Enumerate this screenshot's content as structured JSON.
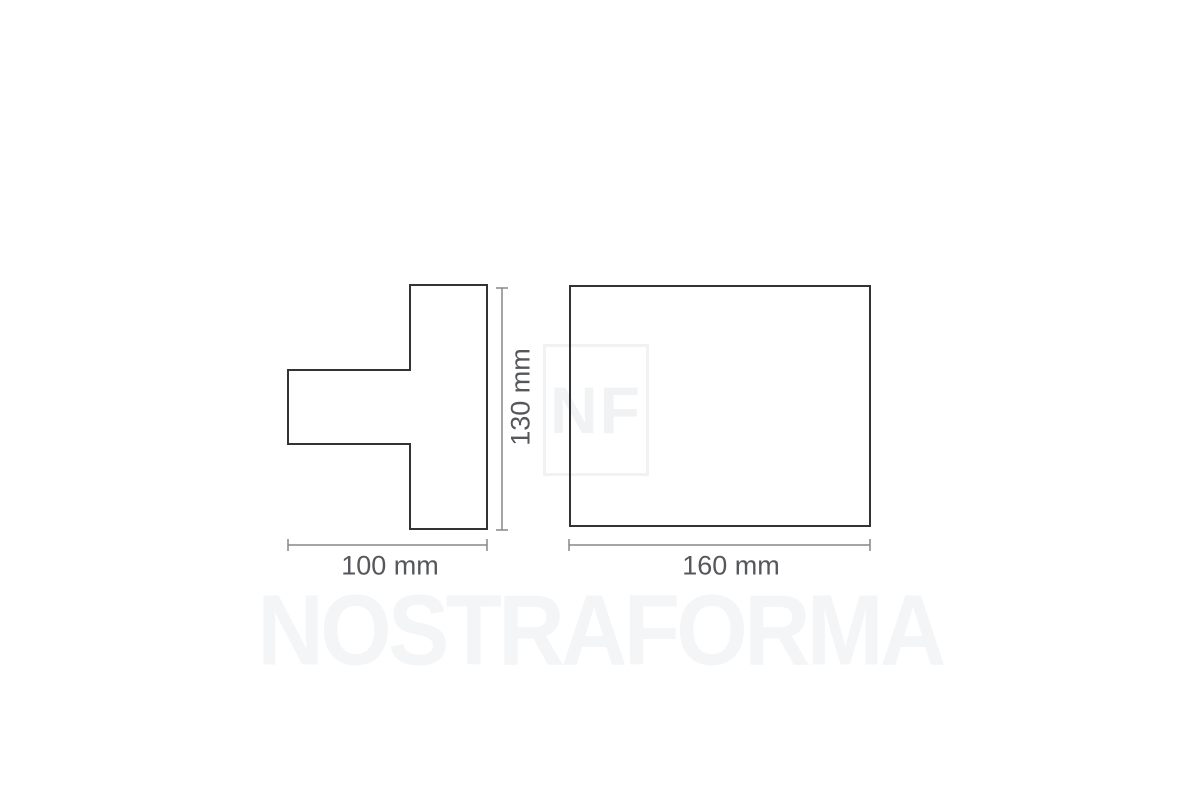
{
  "diagram": {
    "left_view": {
      "name": "side-profile-t-shape",
      "width_label": "100 mm",
      "height_label": "130 mm"
    },
    "right_view": {
      "name": "front-face-rectangle",
      "width_label": "160 mm"
    }
  },
  "watermark": {
    "brand": "NOSTRAFORMA",
    "monogram": "NF"
  },
  "colors": {
    "background": "#ffffff",
    "outline": "#333333",
    "dimension_line": "#85878a",
    "dimension_text": "#56575a",
    "watermark": "#f3f5f7"
  }
}
